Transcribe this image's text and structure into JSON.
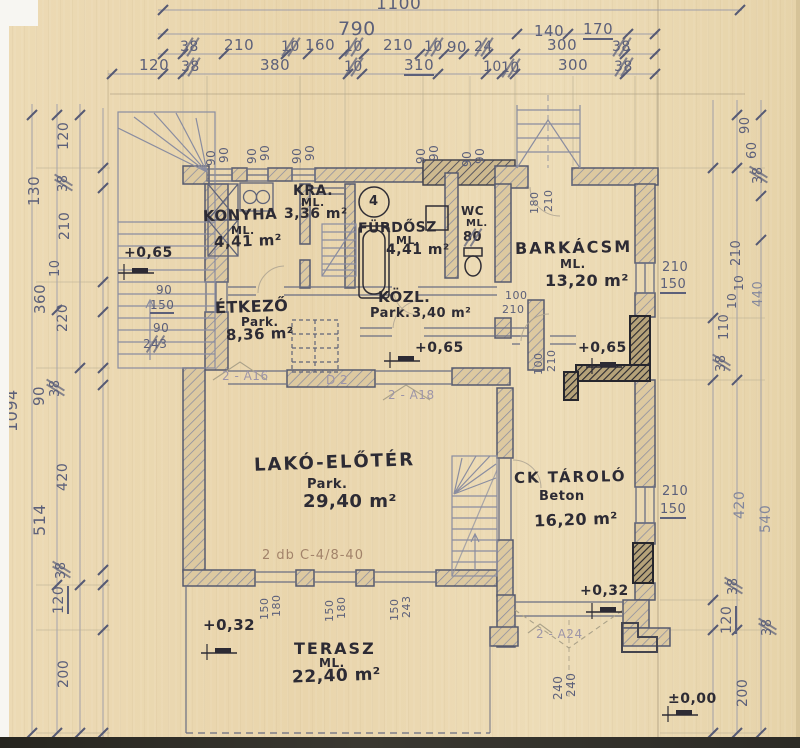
{
  "dim_top": {
    "total": "1100",
    "row2": [
      "790",
      "140",
      "170"
    ],
    "row3": [
      "38",
      "210",
      "10",
      "160",
      "10",
      "210",
      "10",
      "90",
      "24",
      "300",
      "38"
    ],
    "row4": [
      "120",
      "38",
      "380",
      "10",
      "310",
      "10",
      "10",
      "300",
      "38"
    ]
  },
  "dim_left": [
    "120",
    "38",
    "130",
    "210",
    "10",
    "360",
    "220",
    "90",
    "38",
    "1094",
    "420",
    "514",
    "38",
    "120",
    "200"
  ],
  "dim_right": [
    "90",
    "60",
    "38",
    "210",
    "10",
    "10",
    "110",
    "440",
    "38",
    "420",
    "540",
    "38",
    "120",
    "38",
    "200"
  ],
  "openings": {
    "win90": "90",
    "left_win": [
      "90",
      "150"
    ],
    "left_door": [
      "90",
      "243"
    ],
    "barkacs_door": [
      "100",
      "210"
    ],
    "mid_door": [
      "100",
      "210"
    ],
    "entry_door": [
      "180",
      "210"
    ],
    "barkacs_win": [
      "210",
      "150"
    ],
    "ck_win": [
      "210",
      "150"
    ],
    "ck_door": [
      "240",
      "240"
    ],
    "terrace": [
      [
        "150",
        "180"
      ],
      [
        "150",
        "180"
      ],
      [
        "150",
        "243"
      ]
    ]
  },
  "rooms": [
    {
      "name": "KONYHA",
      "finish": "ML.",
      "area": "4,41 m²"
    },
    {
      "name": "KRA.",
      "finish": "ML.",
      "area": "3,36 m²"
    },
    {
      "name": "FÜRDŐSZ",
      "finish": "ML.",
      "area": "4,41 m²"
    },
    {
      "name": "WC",
      "finish": "ML.",
      "area": "80"
    },
    {
      "name": "ÉTKEZŐ",
      "finish": "Park.",
      "area": "8,36 m²"
    },
    {
      "name": "KÖZL.",
      "finish": "Park.",
      "area": "3,40 m²"
    },
    {
      "name": "BARKÁCSM",
      "finish": "ML.",
      "area": "13,20 m²"
    },
    {
      "name": "LAKÓ-ELŐTÉR",
      "finish": "Park.",
      "area": "29,40 m²"
    },
    {
      "name": "CK TÁROLÓ",
      "finish": "Beton",
      "area": "16,20 m²"
    },
    {
      "name": "TERASZ",
      "finish": "ML.",
      "area": "22,40 m²"
    }
  ],
  "levels": {
    "stair_landing": "+0,65",
    "hall": "+0,65",
    "barkacs": "+0,65",
    "ck": "+0,32",
    "terrace": "+0,32",
    "ground": "±0,00"
  },
  "annotations": {
    "a16": "2 - A16",
    "d2": "D 2",
    "a18": "2 - A18",
    "a24": "2 - A24",
    "beam_note": "2 db C-4/8-40",
    "boiler_mark": "4"
  }
}
